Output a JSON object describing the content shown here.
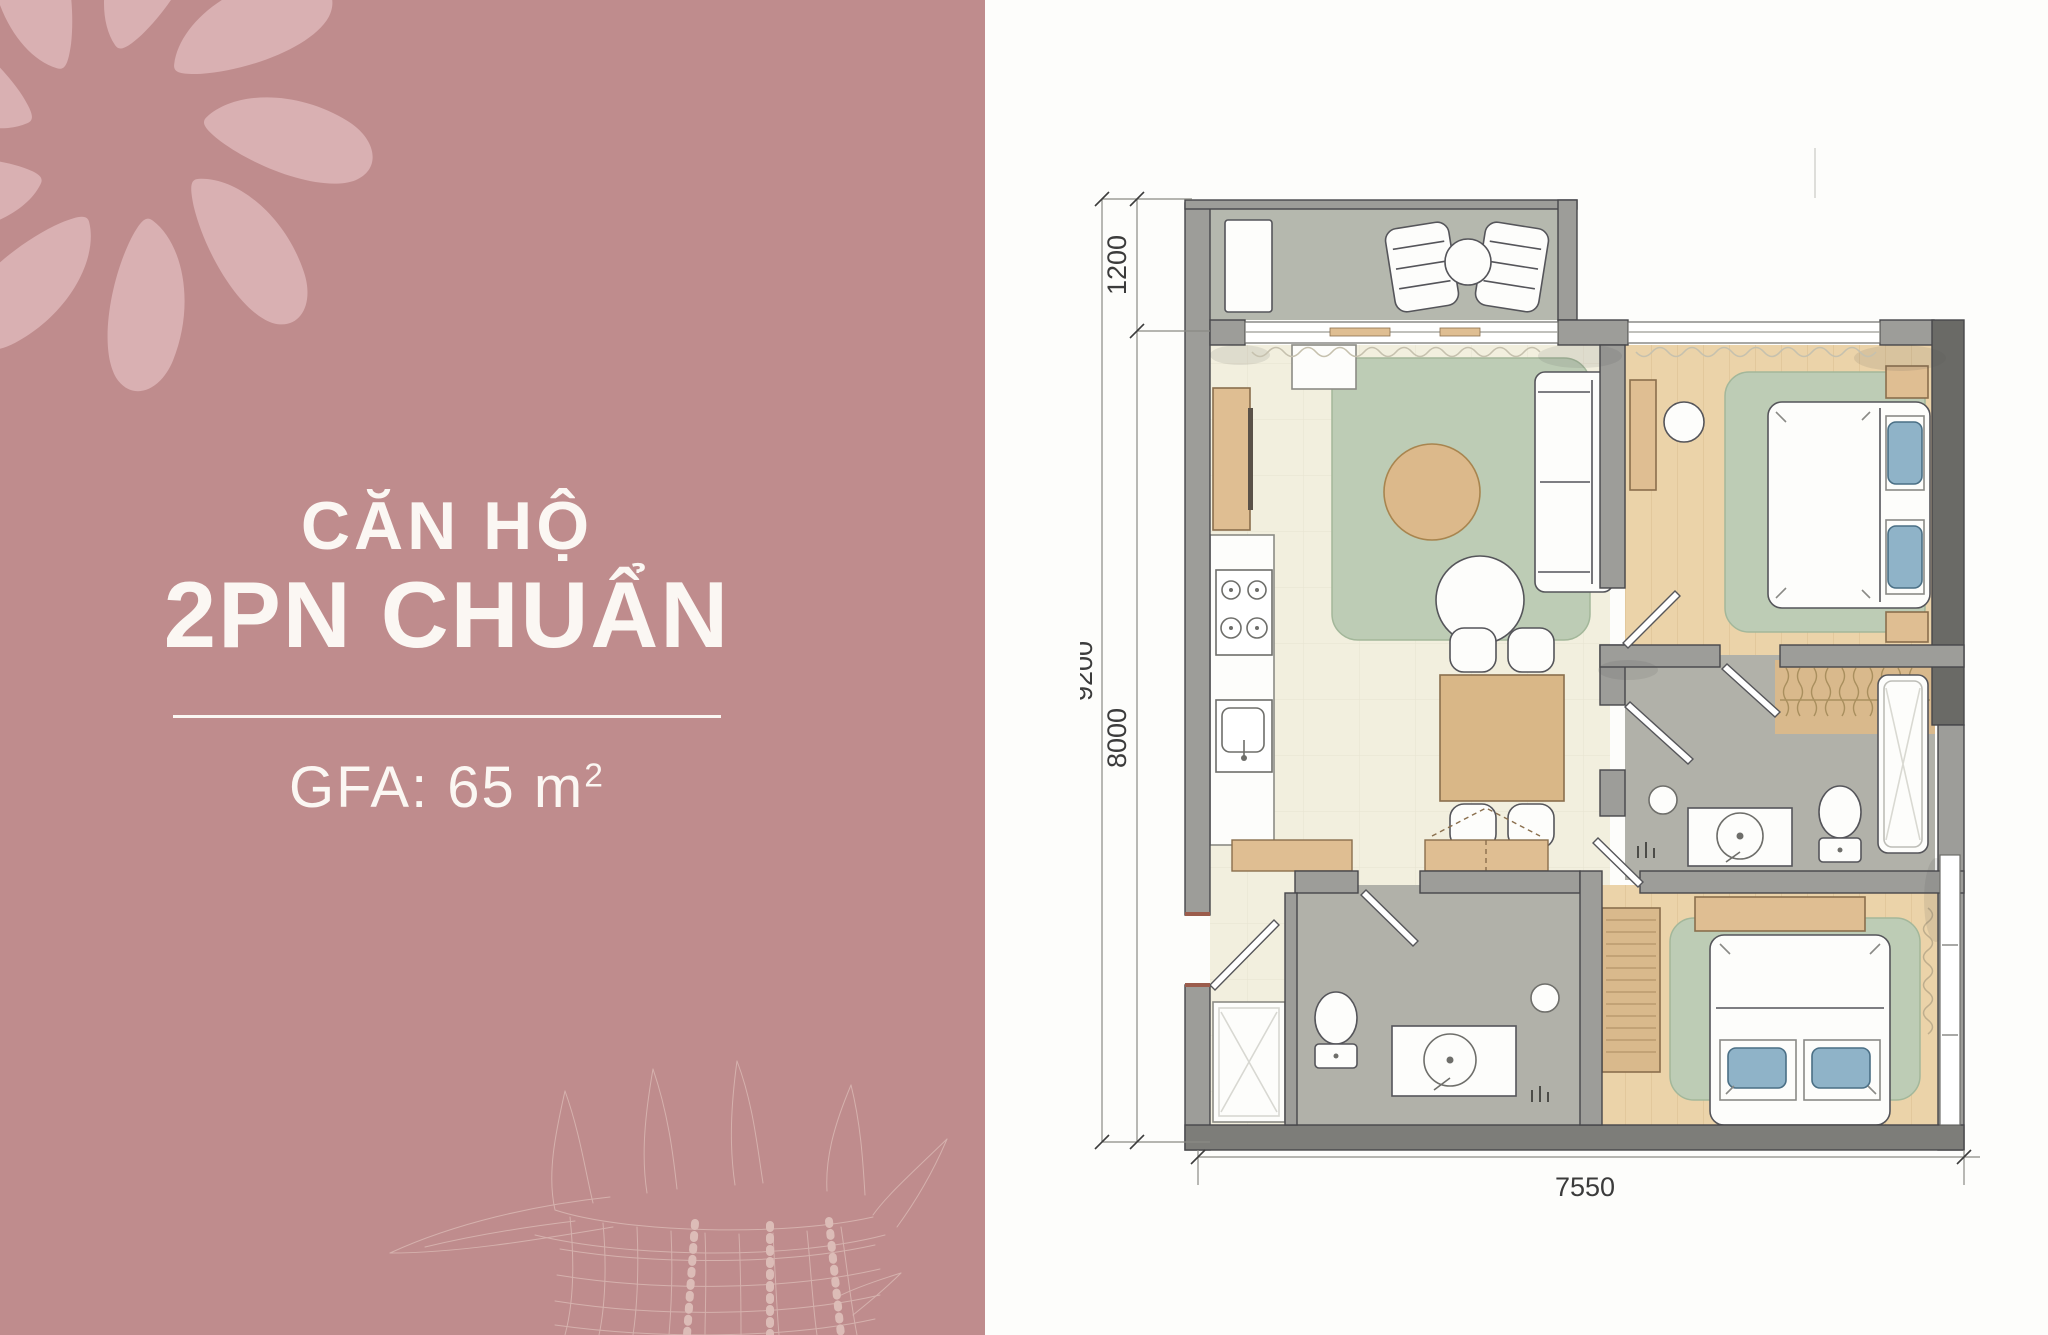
{
  "panel": {
    "title_line1": "CĂN HỘ",
    "title_line2": "2PN CHUẨN",
    "gfa_text": "GFA: 65 m",
    "gfa_sup": "2",
    "bg_color": "#bf8c8d",
    "petal_color": "#d9b0b2",
    "shell_line_color": "#d5b1ad",
    "text_color": "#fbf7f3"
  },
  "plan": {
    "dimensions": {
      "balcony_depth": "1200",
      "total_height": "9200",
      "inner_height": "8000",
      "total_width": "7550"
    },
    "colors": {
      "floor_living": "#f2efde",
      "floor_wood": "#ebd3a9",
      "floor_bath": "#b1b1a9",
      "floor_balcony": "#b5b8ae",
      "rug": "#bdccb5",
      "wall": "#9d9d99",
      "wall_dark": "#6a6a66",
      "wood_furniture": "#dfbe92",
      "pillow": "#8fb3c8"
    }
  }
}
